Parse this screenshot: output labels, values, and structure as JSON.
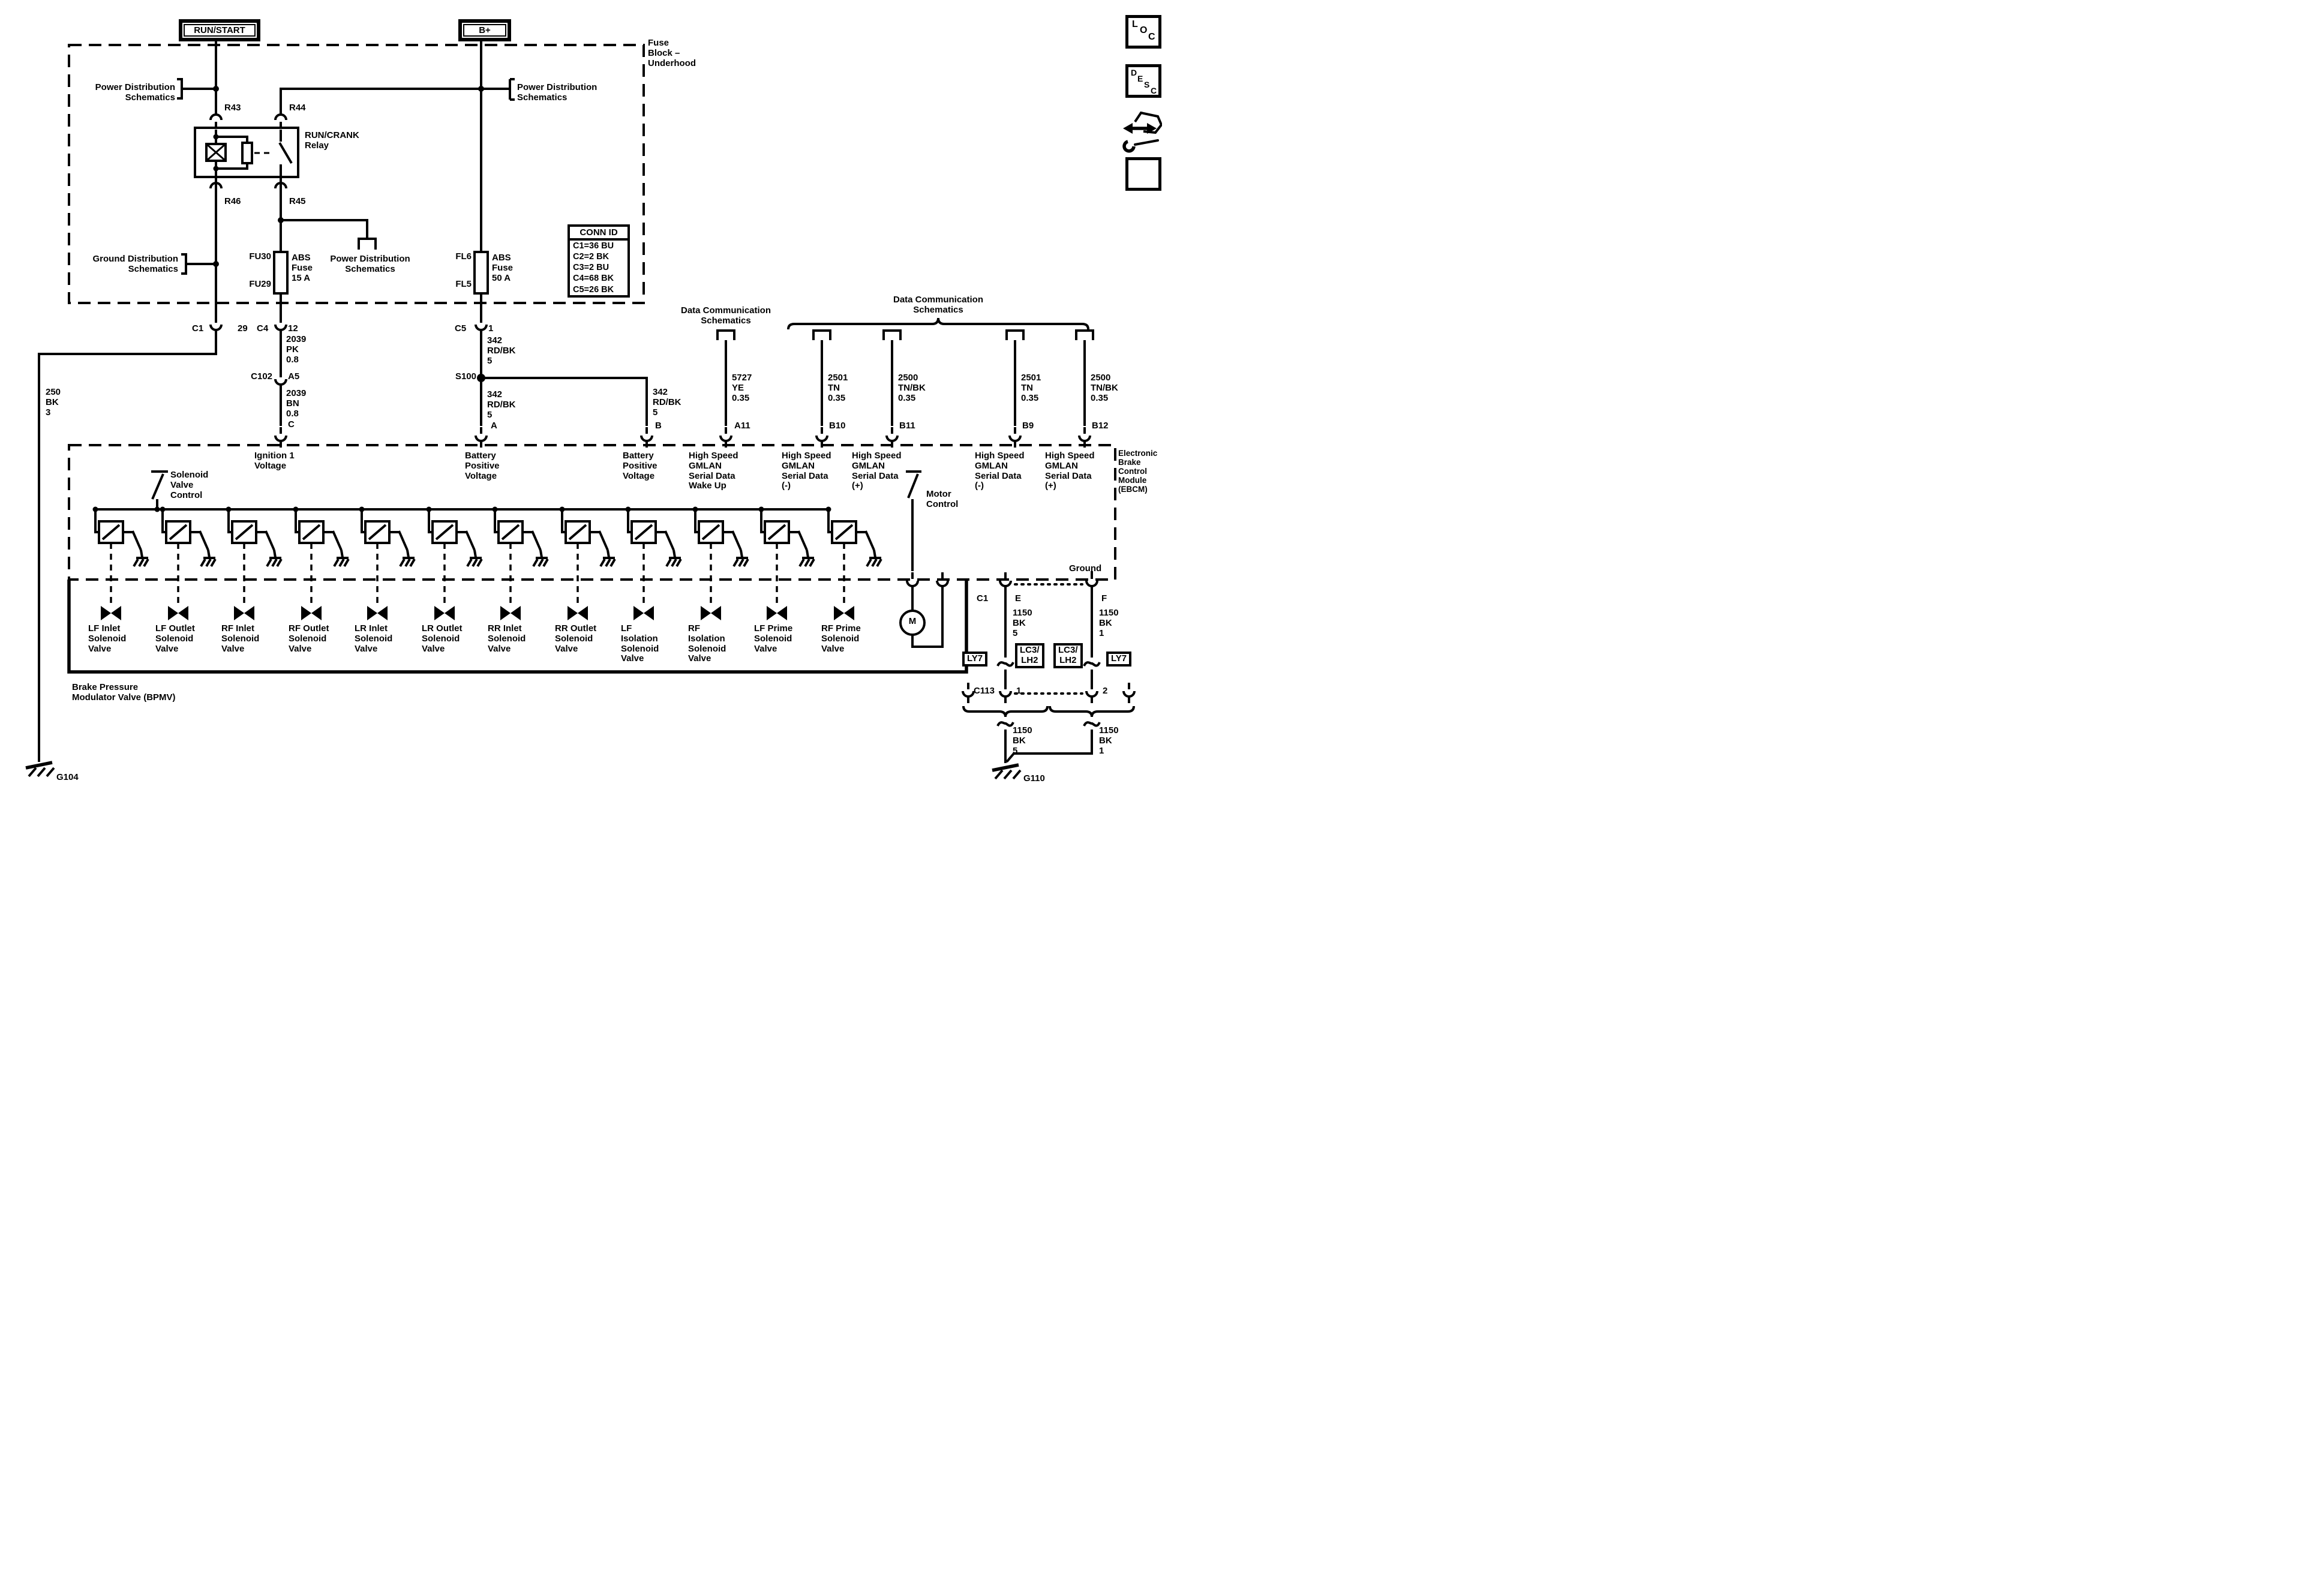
{
  "sources": {
    "run_start": "RUN/START",
    "b_plus": "B+"
  },
  "fuse_block": {
    "label": "Fuse\nBlock –\nUnderhood",
    "power_dist_left": "Power Distribution\nSchematics",
    "power_dist_mid": "Power Distribution\nSchematics",
    "power_dist_right": "Power Distribution\nSchematics",
    "ground_dist": "Ground Distribution\nSchematics",
    "relay_label": "RUN/CRANK\nRelay",
    "pin_r43": "R43",
    "pin_r44": "R44",
    "pin_r45": "R45",
    "pin_r46": "R46",
    "fuse_abs15_top": "FU30",
    "fuse_abs15_bottom": "FU29",
    "fuse_abs15": "ABS\nFuse\n15 A",
    "fuse_abs50_top": "FL6",
    "fuse_abs50_bottom": "FL5",
    "fuse_abs50": "ABS\nFuse\n50 A",
    "conn_id_title": "CONN ID",
    "conn_id_rows": [
      "C1=36 BU",
      "C2=2 BK",
      "C3=2 BU",
      "C4=68 BK",
      "C5=26 BK"
    ]
  },
  "connectors": {
    "c1": "C1",
    "c1_pin": "29",
    "c4": "C4",
    "c4_pin": "12",
    "c5": "C5",
    "c5_pin": "1",
    "c102": "C102",
    "c102_pin": "A5",
    "s100": "S100",
    "term_c": "C",
    "term_a": "A",
    "term_b": "B",
    "term_a11": "A11",
    "term_b10": "B10",
    "term_b11": "B11",
    "term_b9": "B9",
    "term_b12": "B12",
    "c113": "C113",
    "c113_pin1": "1",
    "c113_pin2": "2",
    "c1_ebcm": "C1",
    "term_e": "E",
    "term_f": "F"
  },
  "wires": {
    "ign_feed": "2039\nPK\n0.8",
    "ign_feed2": "2039\nBN\n0.8",
    "left_ground": "250\nBK\n3",
    "batt_c5": "342\nRD/BK\n5",
    "batt_a": "342\nRD/BK\n5",
    "batt_b": "342\nRD/BK\n5",
    "wake_up": "5727\nYE\n0.35",
    "gmlan_minus_b10": "2501\nTN\n0.35",
    "gmlan_plus_b11": "2500\nTN/BK\n0.35",
    "gmlan_minus_b9": "2501\nTN\n0.35",
    "gmlan_plus_b12": "2500\nTN/BK\n0.35",
    "gnd_e": "1150\nBK\n5",
    "gnd_f": "1150\nBK\n1",
    "gnd_left": "1150\nBK\n5",
    "gnd_right": "1150\nBK\n1"
  },
  "data_comm": {
    "left": "Data Communication\nSchematics",
    "right": "Data Communication\nSchematics"
  },
  "ebcm": {
    "label": "Electronic\nBrake\nControl\nModule\n(EBCM)",
    "ignition": "Ignition 1\nVoltage",
    "batt_a": "Battery\nPositive\nVoltage",
    "batt_b": "Battery\nPositive\nVoltage",
    "wake": "High Speed\nGMLAN\nSerial Data\nWake Up",
    "gmlan_b10": "High Speed\nGMLAN\nSerial Data\n(-)",
    "gmlan_b11": "High Speed\nGMLAN\nSerial Data\n(+)",
    "gmlan_b9": "High Speed\nGMLAN\nSerial Data\n(-)",
    "gmlan_b12": "High Speed\nGMLAN\nSerial Data\n(+)",
    "solenoid_ctl": "Solenoid\nValve\nControl",
    "motor_ctl": "Motor\nControl",
    "ground": "Ground"
  },
  "bpmv": {
    "label": "Brake Pressure\nModulator Valve (BPMV)",
    "motor": "M",
    "valves": [
      "LF Inlet\nSolenoid\nValve",
      "LF Outlet\nSolenoid\nValve",
      "RF Inlet\nSolenoid\nValve",
      "RF Outlet\nSolenoid\nValve",
      "LR Inlet\nSolenoid\nValve",
      "LR Outlet\nSolenoid\nValve",
      "RR Inlet\nSolenoid\nValve",
      "RR Outlet\nSolenoid\nValve",
      "LF\nIsolation\nSolenoid\nValve",
      "RF\nIsolation\nSolenoid\nValve",
      "LF Prime\nSolenoid\nValve",
      "RF Prime\nSolenoid\nValve"
    ]
  },
  "engine_codes": {
    "ly7_left": "LY7",
    "lc3_left": "LC3/\nLH2",
    "lc3_right": "LC3/\nLH2",
    "ly7_right": "LY7"
  },
  "grounds": {
    "g104": "G104",
    "g110": "G110"
  },
  "nav_icons": {
    "loc": [
      "L",
      "O",
      "C"
    ],
    "desc": [
      "D",
      "E",
      "S",
      "C"
    ]
  }
}
